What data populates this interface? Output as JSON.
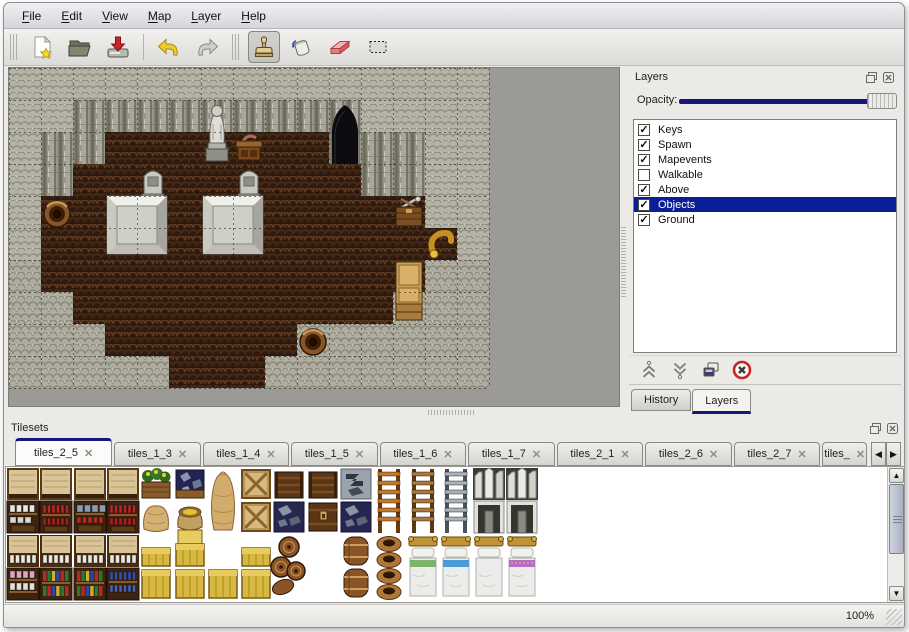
{
  "menu": {
    "items": [
      {
        "label": "File"
      },
      {
        "label": "Edit"
      },
      {
        "label": "View"
      },
      {
        "label": "Map"
      },
      {
        "label": "Layer"
      },
      {
        "label": "Help"
      }
    ]
  },
  "toolbar": {
    "buttons": [
      {
        "name": "new",
        "group": 1
      },
      {
        "name": "open",
        "group": 1
      },
      {
        "name": "save",
        "group": 1
      },
      {
        "name": "undo",
        "group": 2
      },
      {
        "name": "redo",
        "group": 2
      },
      {
        "name": "stamp",
        "group": 3,
        "active": true
      },
      {
        "name": "fill",
        "group": 3
      },
      {
        "name": "eraser",
        "group": 3
      },
      {
        "name": "select",
        "group": 3
      }
    ]
  },
  "map": {
    "tile_size": 32,
    "cols": 15,
    "rows": 10,
    "legend": {
      "T": "wall-top",
      "W": "wall-face",
      "B": "dirt-floor",
      "C": "cobble-floor"
    },
    "grid": [
      "TTTTTTTTTTTTTTT",
      "TTWWWWWWWWWTTTT",
      "TWWBBBBBBBWWWTT",
      "TWBBBBBBBBBWWTT",
      "TBBBBBBBBBBBBTT",
      "TBBBBBBBBBBBBBT",
      "CBBBBBBBBBBBBCC",
      "CCBBBBBBBBBBCCC",
      "CCCBBBBBBCCCCCC",
      "CCCCCBBBCCCCCCC"
    ],
    "objects": [
      {
        "type": "statue",
        "col": 6,
        "row": 1,
        "h": 2
      },
      {
        "type": "table",
        "col": 7,
        "row": 2,
        "h": 1
      },
      {
        "type": "cave",
        "col": 10,
        "row": 1,
        "h": 2
      },
      {
        "type": "tombstone",
        "col": 4,
        "row": 3,
        "h": 1
      },
      {
        "type": "tombstone",
        "col": 7,
        "row": 3,
        "h": 1
      },
      {
        "type": "platform",
        "col": 3,
        "row": 4,
        "w": 2,
        "h": 2
      },
      {
        "type": "platform",
        "col": 6,
        "row": 4,
        "w": 2,
        "h": 2
      },
      {
        "type": "barrel",
        "col": 1,
        "row": 4,
        "h": 1
      },
      {
        "type": "crate-tools",
        "col": 12,
        "row": 4,
        "h": 1
      },
      {
        "type": "horn",
        "col": 13,
        "row": 5,
        "h": 1
      },
      {
        "type": "cabinet",
        "col": 12,
        "row": 6,
        "h": 2
      },
      {
        "type": "barrel",
        "col": 9,
        "row": 8,
        "h": 1
      }
    ]
  },
  "layers_panel": {
    "title": "Layers",
    "opacity_label": "Opacity:",
    "opacity_value": 100,
    "layers": [
      {
        "name": "Keys",
        "checked": true,
        "selected": false
      },
      {
        "name": "Spawn",
        "checked": true,
        "selected": false
      },
      {
        "name": "Mapevents",
        "checked": true,
        "selected": false
      },
      {
        "name": "Walkable",
        "checked": false,
        "selected": false
      },
      {
        "name": "Above",
        "checked": true,
        "selected": false
      },
      {
        "name": "Objects",
        "checked": true,
        "selected": true
      },
      {
        "name": "Ground",
        "checked": true,
        "selected": false
      }
    ],
    "buttons": [
      {
        "name": "move-up"
      },
      {
        "name": "move-down"
      },
      {
        "name": "duplicate"
      },
      {
        "name": "delete"
      }
    ],
    "tabs": [
      {
        "label": "History",
        "active": false
      },
      {
        "label": "Layers",
        "active": true
      }
    ]
  },
  "tilesets_panel": {
    "title": "Tilesets",
    "tabs": [
      {
        "label": "tiles_2_5",
        "active": true
      },
      {
        "label": "tiles_1_3",
        "active": false
      },
      {
        "label": "tiles_1_4",
        "active": false
      },
      {
        "label": "tiles_1_5",
        "active": false
      },
      {
        "label": "tiles_1_6",
        "active": false
      },
      {
        "label": "tiles_1_7",
        "active": false
      },
      {
        "label": "tiles_2_1",
        "active": false
      },
      {
        "label": "tiles_2_6",
        "active": false
      },
      {
        "label": "tiles_2_7",
        "active": false
      },
      {
        "label": "tiles_",
        "active": false,
        "truncated": true
      }
    ],
    "tiles": [
      {
        "t": "shelf-top",
        "c": 0,
        "r": 0
      },
      {
        "t": "shelf-top",
        "c": 1,
        "r": 0
      },
      {
        "t": "shelf-top",
        "c": 2,
        "r": 0
      },
      {
        "t": "shelf-top",
        "c": 3,
        "r": 0
      },
      {
        "t": "planter-yellow",
        "c": 4,
        "r": 0
      },
      {
        "t": "planter-blue",
        "c": 5,
        "r": 0
      },
      {
        "t": "sack-tall",
        "c": 6,
        "r": 0,
        "h": 2
      },
      {
        "t": "crate-x",
        "c": 7,
        "r": 0
      },
      {
        "t": "chest-top",
        "c": 8,
        "r": 0
      },
      {
        "t": "chest-top",
        "c": 9,
        "r": 0
      },
      {
        "t": "metal-scrap",
        "c": 10,
        "r": 0
      },
      {
        "t": "ladder-orange",
        "c": 11,
        "r": 0,
        "h": 2
      },
      {
        "t": "ladder-brown",
        "c": 12,
        "r": 0,
        "h": 2
      },
      {
        "t": "ladder-steel",
        "c": 13,
        "r": 0,
        "h": 2
      },
      {
        "t": "arch-top",
        "c": 14,
        "r": 0
      },
      {
        "t": "arch-top",
        "c": 15,
        "r": 0
      },
      {
        "t": "shelf-dishes",
        "c": 0,
        "r": 1
      },
      {
        "t": "shelf-bottles-red",
        "c": 1,
        "r": 1
      },
      {
        "t": "shelf-pots",
        "c": 2,
        "r": 1
      },
      {
        "t": "shelf-bottles-red",
        "c": 3,
        "r": 1
      },
      {
        "t": "sack-big",
        "c": 4,
        "r": 1
      },
      {
        "t": "sack-open",
        "c": 5,
        "r": 1
      },
      {
        "t": "crate-x",
        "c": 7,
        "r": 1
      },
      {
        "t": "metal-navy",
        "c": 8,
        "r": 1
      },
      {
        "t": "chest-front",
        "c": 9,
        "r": 1
      },
      {
        "t": "metal-navy",
        "c": 10,
        "r": 1
      },
      {
        "t": "arch-door",
        "c": 14,
        "r": 1
      },
      {
        "t": "arch-door",
        "c": 15,
        "r": 1
      },
      {
        "t": "shelf-top-jars",
        "c": 0,
        "r": 2
      },
      {
        "t": "shelf-top-jars",
        "c": 1,
        "r": 2
      },
      {
        "t": "shelf-top-jars",
        "c": 2,
        "r": 2
      },
      {
        "t": "shelf-top-jars",
        "c": 3,
        "r": 2
      },
      {
        "t": "crate-yellow-half",
        "c": 4,
        "r": 2
      },
      {
        "t": "crate-yellow-tall",
        "c": 5,
        "r": 2
      },
      {
        "t": "crate-yellow-half",
        "c": 7,
        "r": 2
      },
      {
        "t": "barrel-group",
        "c": 8,
        "r": 2,
        "h": 2
      },
      {
        "t": "barrel-stack",
        "c": 10,
        "r": 2,
        "h": 2
      },
      {
        "t": "pot-stack",
        "c": 11,
        "r": 2,
        "h": 2
      },
      {
        "t": "bed",
        "c": 12,
        "r": 2,
        "h": 2,
        "color": "green"
      },
      {
        "t": "bed",
        "c": 13,
        "r": 2,
        "h": 2,
        "color": "blue"
      },
      {
        "t": "bed",
        "c": 14,
        "r": 2,
        "h": 2,
        "color": "white"
      },
      {
        "t": "bed",
        "c": 15,
        "r": 2,
        "h": 2,
        "color": "purple"
      },
      {
        "t": "shelf-jars",
        "c": 0,
        "r": 3
      },
      {
        "t": "shelf-books",
        "c": 1,
        "r": 3
      },
      {
        "t": "shelf-books",
        "c": 2,
        "r": 3
      },
      {
        "t": "shelf-bottles-blue",
        "c": 3,
        "r": 3
      },
      {
        "t": "crate-yellow",
        "c": 4,
        "r": 3
      },
      {
        "t": "crate-yellow",
        "c": 5,
        "r": 3
      },
      {
        "t": "crate-yellow",
        "c": 6,
        "r": 3
      },
      {
        "t": "crate-yellow",
        "c": 7,
        "r": 3
      }
    ]
  },
  "status_bar": {
    "zoom": "100%"
  },
  "colors": {
    "accent_navy": "#16167e",
    "selection_navy": "#0c1e96",
    "window_bg": "#ebeae6",
    "map_outside": "#9b9a96"
  }
}
